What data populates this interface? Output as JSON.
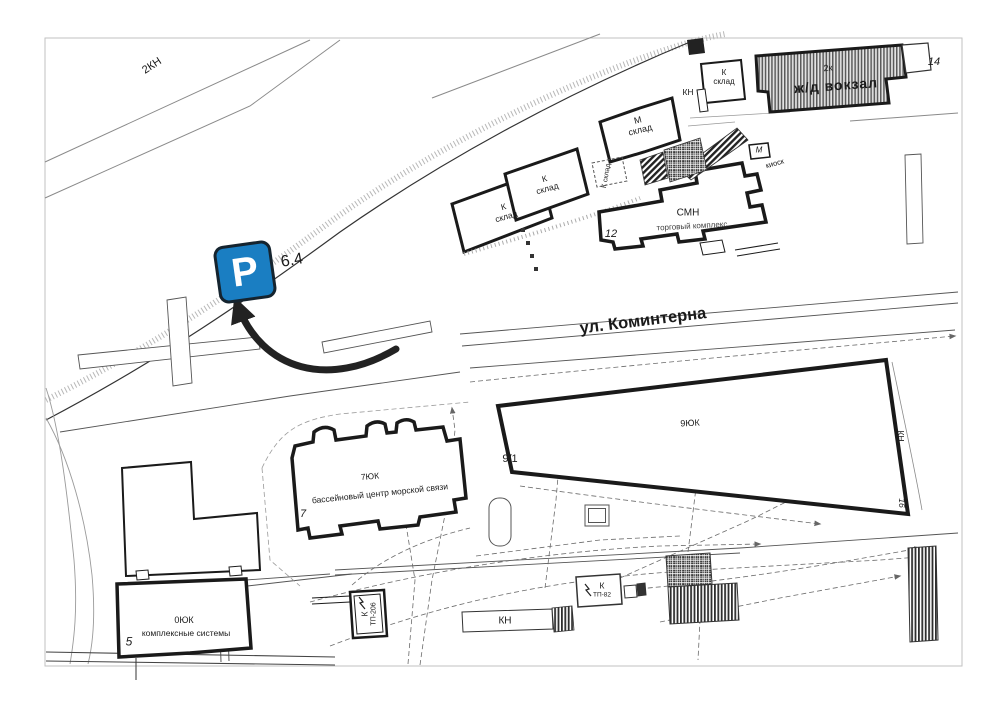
{
  "map": {
    "street_label": "ул. Коминтерна",
    "parking": {
      "symbol": "P",
      "distance_label": "6.4"
    },
    "parcel_top_left": "2КН",
    "buildings": {
      "station": {
        "code": "2к",
        "name": "ж/д вокзал",
        "number": "14"
      },
      "station_shed": {
        "code": "К",
        "name": "склад",
        "side_label": "КН"
      },
      "kiosk": {
        "code": "М",
        "name": "киоск"
      },
      "warehouse_sw": {
        "code": "К",
        "name": "склад"
      },
      "warehouse_mid": {
        "code": "К",
        "name": "склад"
      },
      "warehouse_m": {
        "code": "М",
        "name": "склад"
      },
      "warehouse_small": {
        "label": "К склад"
      },
      "trade_center": {
        "code": "СМН",
        "name": "торговый комплекс",
        "number": "12"
      },
      "long_building": {
        "code": "9ЮК",
        "number": "9/1",
        "side_label": "КН",
        "side_number": "16"
      },
      "pool_center": {
        "code": "7ЮК",
        "name": "бассейновый центр морской связи",
        "number": "7"
      },
      "complex_systems": {
        "code": "0ЮК",
        "name": "комплексные системы",
        "number": "5"
      },
      "tp206": {
        "code": "К",
        "name": "ТП-206"
      },
      "tp82": {
        "code": "К",
        "name": "ТП-82"
      },
      "kn_strip": {
        "label": "КН"
      }
    },
    "icons": {
      "lightning": "↯"
    },
    "colors": {
      "parking_blue": "#1a7ec2",
      "line_black": "#1a1a1a",
      "line_gray": "#888888"
    }
  }
}
